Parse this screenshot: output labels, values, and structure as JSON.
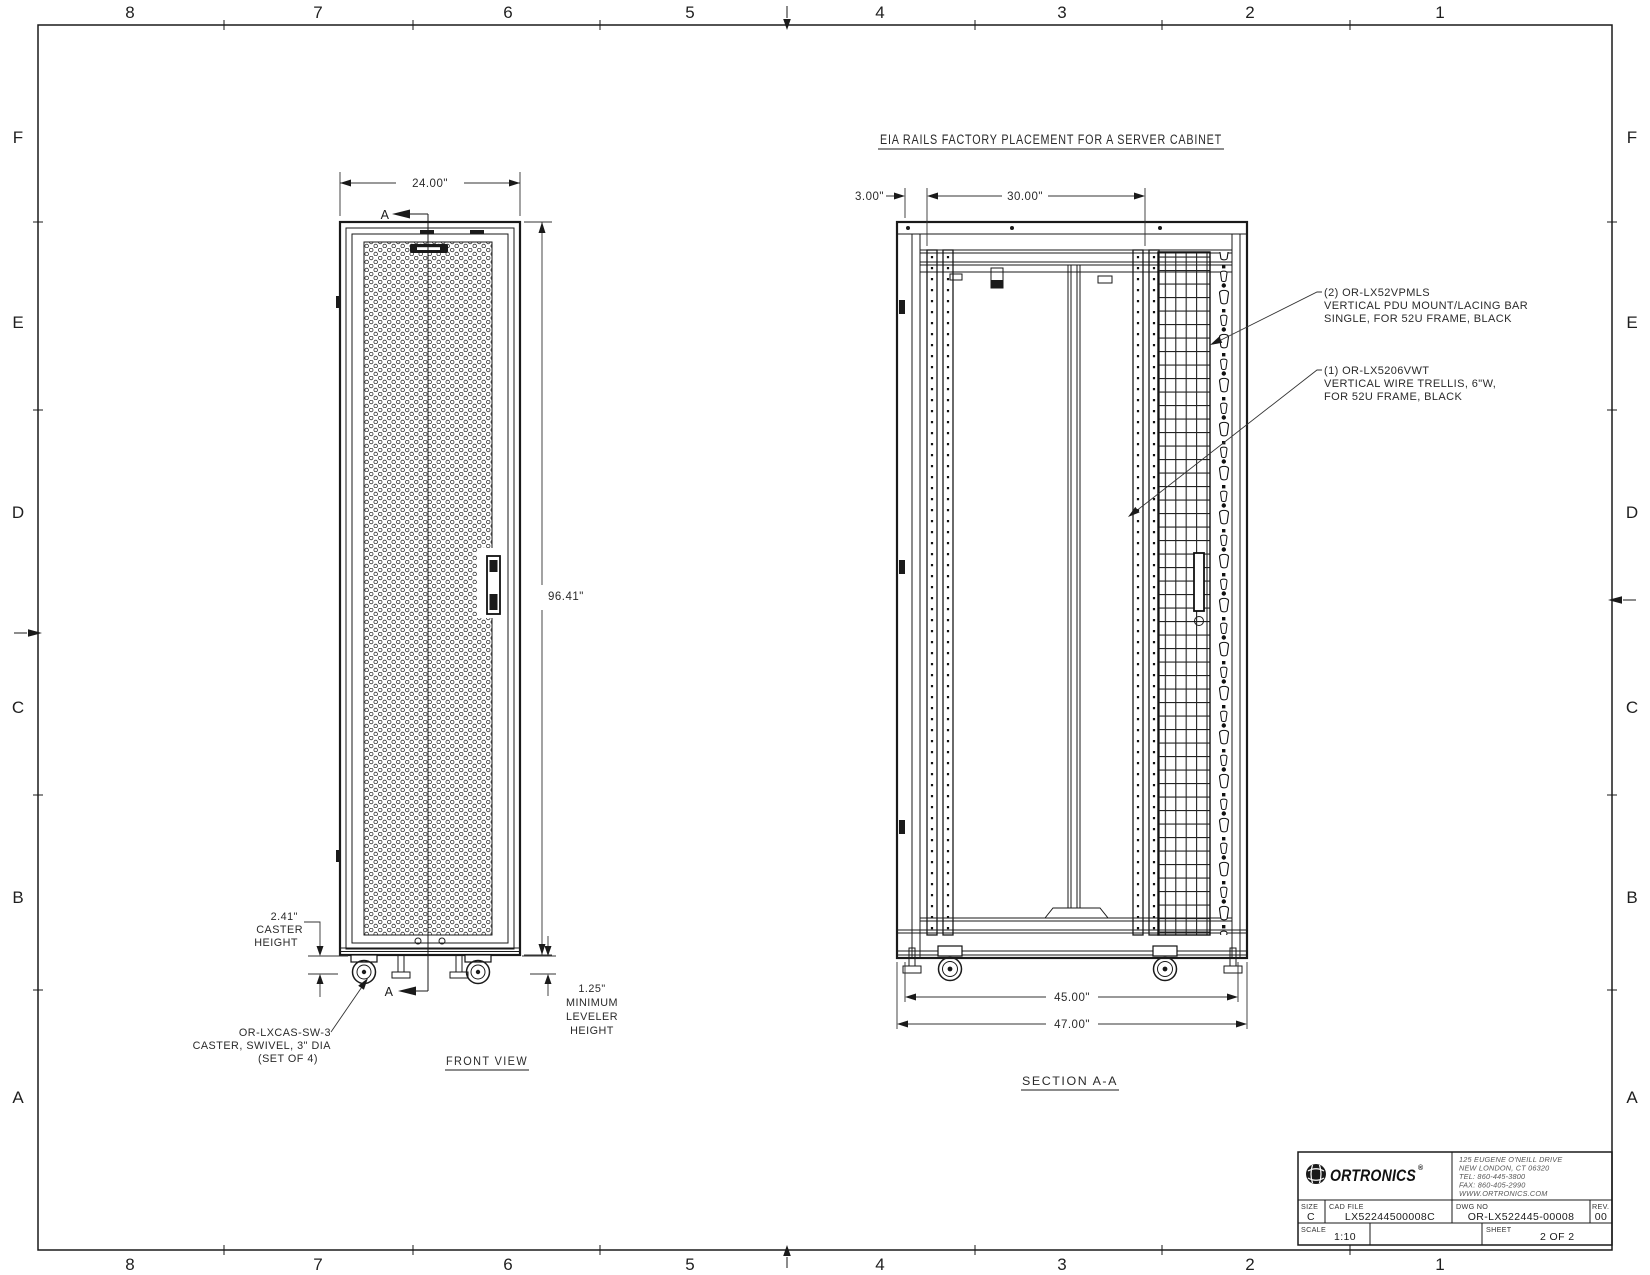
{
  "drawing": {
    "title": "EIA RAILS FACTORY PLACEMENT FOR A SERVER CABINET",
    "border": {
      "cols": [
        "8",
        "7",
        "6",
        "5",
        "4",
        "3",
        "2",
        "1"
      ],
      "rows": [
        "F",
        "E",
        "D",
        "C",
        "B",
        "A"
      ]
    },
    "front_view": {
      "label": "FRONT VIEW",
      "dim_width": "24.00\"",
      "dim_height": "96.41\"",
      "section_marker": "A",
      "caster_height": {
        "l1": "2.41\"",
        "l2": "CASTER",
        "l3": "HEIGHT"
      },
      "leveler": {
        "l1": "1.25\"",
        "l2": "MINIMUM",
        "l3": "LEVELER",
        "l4": "HEIGHT"
      },
      "caster_callout": {
        "l1": "OR-LXCAS-SW-3",
        "l2": "CASTER, SWIVEL, 3\" DIA",
        "l3": "(SET OF 4)"
      }
    },
    "section_view": {
      "label": "SECTION A-A",
      "dim_offset": "3.00\"",
      "dim_rails": "30.00\"",
      "dim_inner": "45.00\"",
      "dim_outer": "47.00\"",
      "callout_pdu": {
        "l1": "(2) OR-LX52VPMLS",
        "l2": "VERTICAL PDU MOUNT/LACING BAR",
        "l3": "SINGLE, FOR 52U FRAME, BLACK"
      },
      "callout_trellis": {
        "l1": "(1) OR-LX5206VWT",
        "l2": "VERTICAL WIRE TRELLIS, 6\"W,",
        "l3": "FOR 52U FRAME, BLACK"
      }
    },
    "title_block": {
      "company": "ORTRONICS",
      "reg": "®",
      "addr1": "125 EUGENE O'NEILL DRIVE",
      "addr2": "NEW LONDON, CT 06320",
      "addr3": "TEL: 860-445-3800",
      "addr4": "FAX: 860-405-2990",
      "addr5": "WWW.ORTRONICS.COM",
      "size_label": "SIZE",
      "size_value": "C",
      "cad_label": "CAD FILE",
      "cad_value": "LX52244500008C",
      "dwg_label": "DWG NO",
      "dwg_value": "OR-LX522445-00008",
      "rev_label": "REV.",
      "rev_value": "00",
      "scale_label": "SCALE",
      "scale_value": "1:10",
      "sheet_label": "SHEET",
      "sheet_value": "2 OF 2"
    }
  }
}
